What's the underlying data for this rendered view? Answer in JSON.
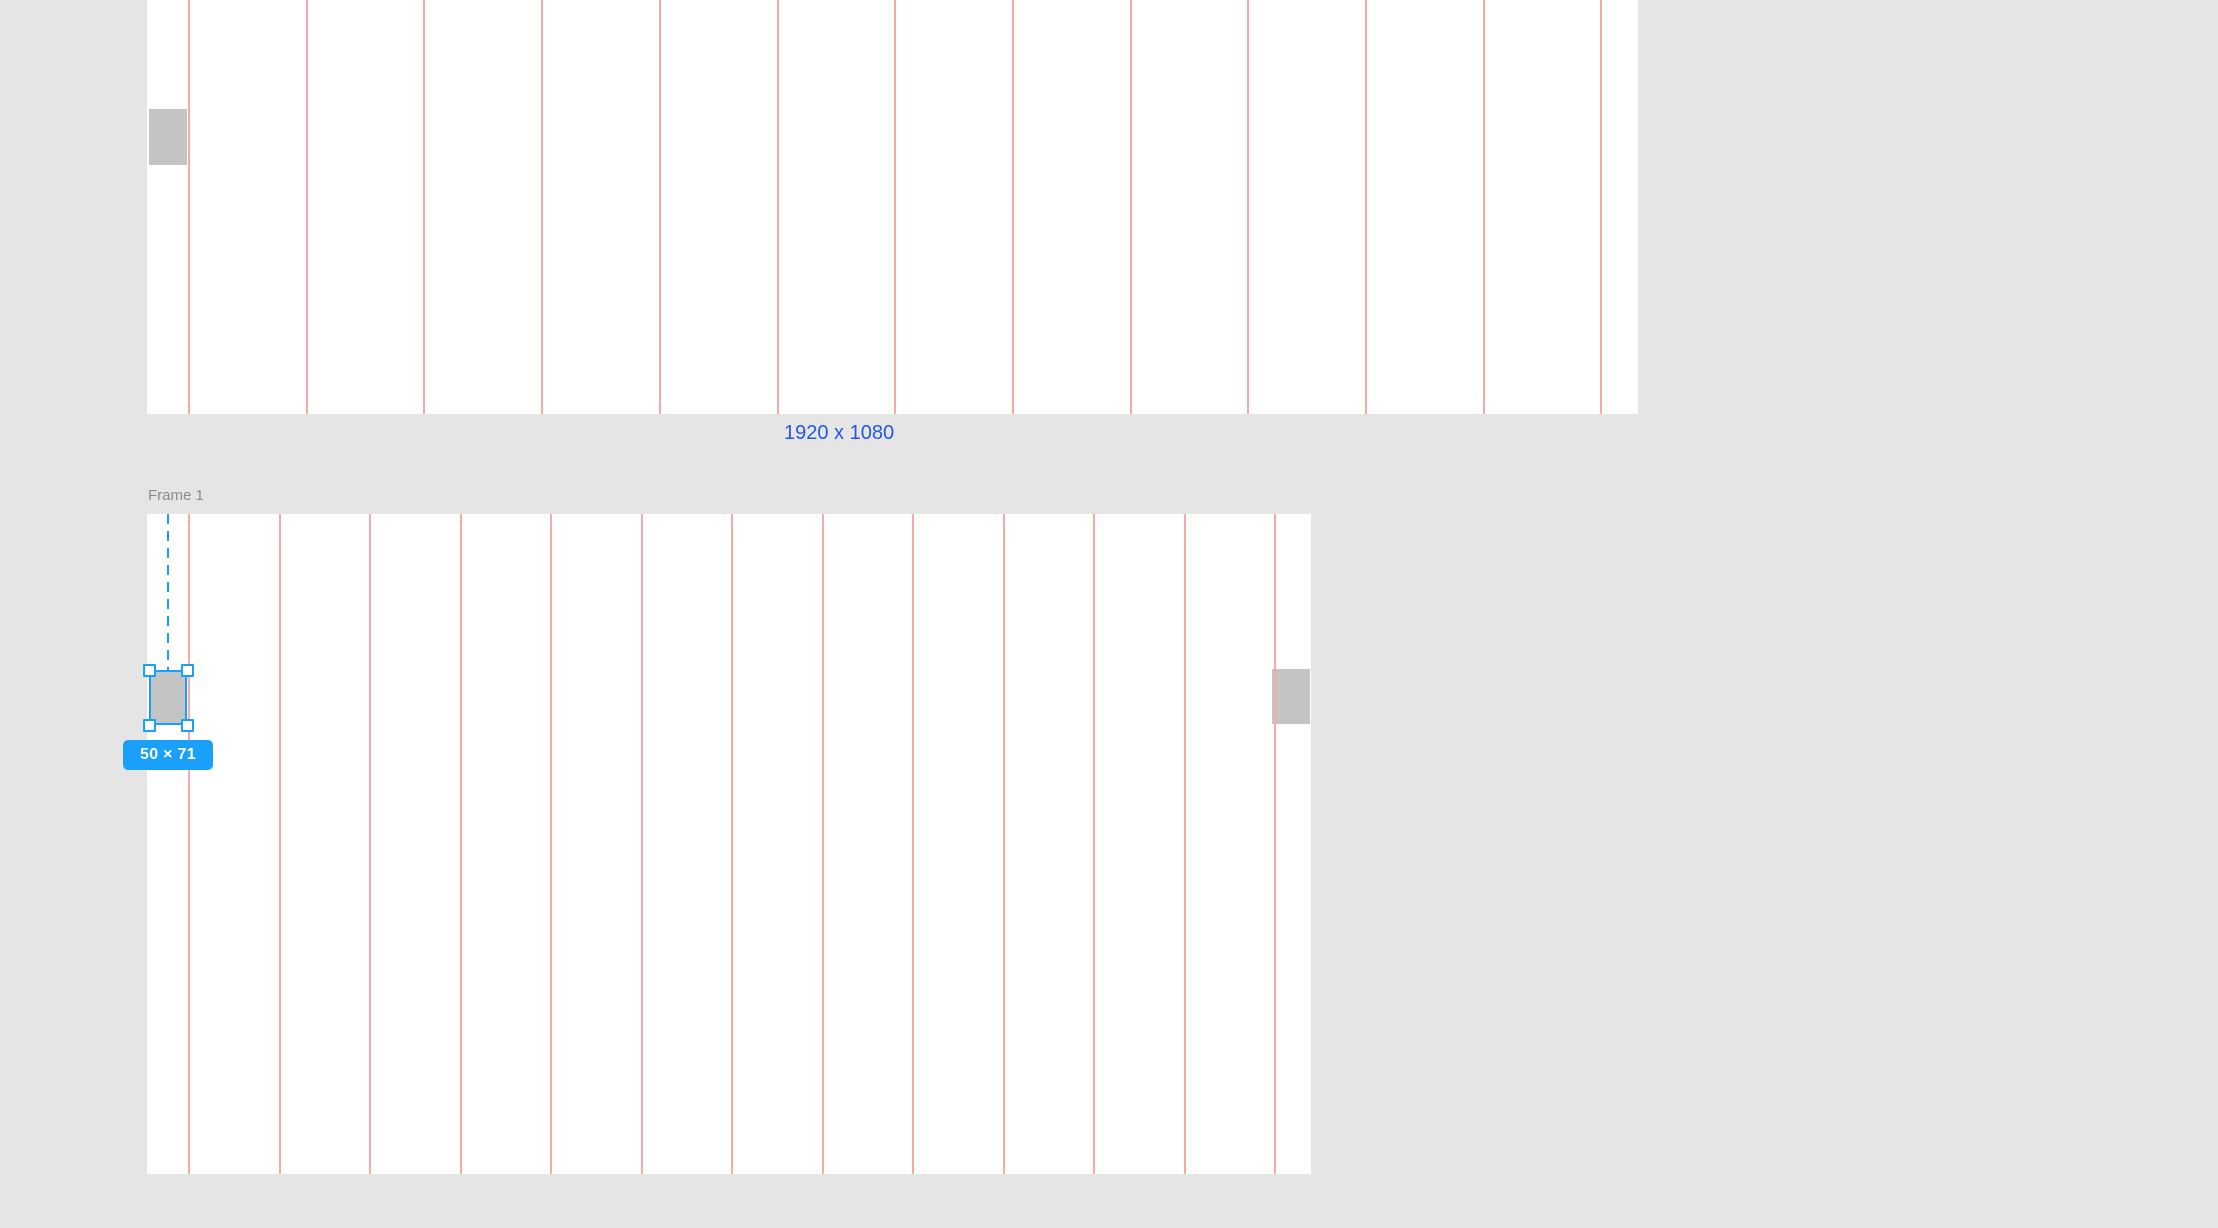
{
  "canvas": {
    "background": "#e5e5e5"
  },
  "colors": {
    "canvas_bg": "#e5e5e5",
    "frame_background": "#ffffff",
    "grid_line_red": "#f5a9a9",
    "object_gray": "#c4c4c4",
    "selection_blue": "#18a0fb",
    "dimension_link_blue": "#2458e0",
    "frame_label_gray": "#8c8c8c",
    "badge_text": "#ffffff"
  },
  "top_frame": {
    "size_caption": "1920 x 1080",
    "grid": {
      "lines": 13,
      "first_offset": 41,
      "spacing": 117.7
    }
  },
  "frame_1": {
    "label": "Frame 1",
    "grid": {
      "lines": 13,
      "first_offset": 41,
      "spacing": 90.5
    }
  },
  "selection": {
    "size_badge": "50 × 71"
  }
}
